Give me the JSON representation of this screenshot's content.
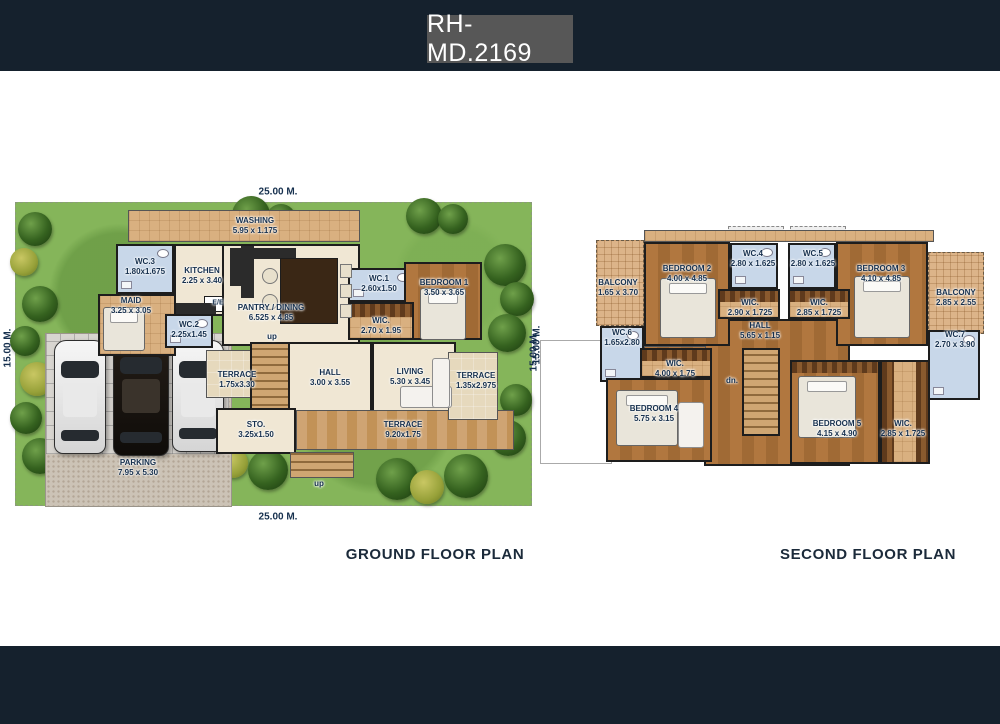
{
  "header": {
    "title": "RH-MD.2169"
  },
  "colors": {
    "header_bg": "#15212d",
    "title_box_bg": "#575757",
    "caption_color": "#1b2a3a",
    "lawn_green": "#85b55a",
    "room_label_color": "#16304e",
    "wc_blue": "#c8d7e9",
    "wood_brown": "#b1773f"
  },
  "ground_floor": {
    "caption": "GROUND FLOOR PLAN",
    "dims": {
      "top": "25.00 M.",
      "bottom": "25.00 M.",
      "left": "15.00 M.",
      "right": "15.00 M."
    },
    "rooms": {
      "washing": {
        "name": "WASHING",
        "size": "5.95 x 1.175"
      },
      "wc3": {
        "name": "WC.3",
        "size": "1.80x1.675"
      },
      "kitchen": {
        "name": "KITCHEN",
        "size": "2.25 x 3.40"
      },
      "maid": {
        "name": "MAID",
        "size": "3.25 x 3.05"
      },
      "wc2": {
        "name": "WC.2",
        "size": "2.25x1.45"
      },
      "electrical": {
        "name": "E/E"
      },
      "pantry_dining": {
        "name": "PANTRY / DINING",
        "size": "6.525 x 4.85"
      },
      "wc1": {
        "name": "WC.1",
        "size": "2.60x1.50"
      },
      "bedroom1": {
        "name": "BEDROOM 1",
        "size": "3.50 x 3.65"
      },
      "wic": {
        "name": "WIC.",
        "size": "2.70 x 1.95"
      },
      "terrace_left": {
        "name": "TERRACE",
        "size": "1.75x3.30"
      },
      "hall": {
        "name": "HALL",
        "size": "3.00 x 3.55"
      },
      "living": {
        "name": "LIVING",
        "size": "5.30 x 3.45"
      },
      "storage": {
        "name": "STO.",
        "size": "3.25x1.50"
      },
      "terrace_bottom": {
        "name": "TERRACE",
        "size": "9.20x1.75"
      },
      "terrace_right": {
        "name": "TERRACE",
        "size": "1.35x2.975"
      },
      "parking": {
        "name": "PARKING",
        "size": "7.95 x 5.30"
      }
    },
    "stair_label_up_main": "up",
    "stair_label_up_terrace": "up"
  },
  "second_floor": {
    "caption": "SECOND FLOOR PLAN",
    "dims": {
      "left": "15.00 M."
    },
    "rooms": {
      "balcony_left": {
        "name": "BALCONY",
        "size": "1.65 x 3.70"
      },
      "bedroom2": {
        "name": "BEDROOM 2",
        "size": "4.00 x 4.85"
      },
      "wc4": {
        "name": "WC.4",
        "size": "2.80 x 1.625"
      },
      "wc5": {
        "name": "WC.5",
        "size": "2.80 x 1.625"
      },
      "bedroom3": {
        "name": "BEDROOM 3",
        "size": "4.10 x 4.85"
      },
      "balcony_right": {
        "name": "BALCONY",
        "size": "2.85 x 2.55"
      },
      "wc6": {
        "name": "WC.6",
        "size": "1.65x2.80"
      },
      "wic_bedroom2": {
        "name": "WIC.",
        "size": "2.90 x 1.725"
      },
      "wic_bedroom3": {
        "name": "WIC.",
        "size": "2.85 x 1.725"
      },
      "hall": {
        "name": "HALL",
        "size": "5.65 x 1.15"
      },
      "wc7": {
        "name": "WC.7",
        "size": "2.70 x 3.90"
      },
      "wic_bedroom4": {
        "name": "WIC.",
        "size": "4.00 x 1.75"
      },
      "bedroom4": {
        "name": "BEDROOM 4",
        "size": "5.75 x 3.15"
      },
      "bedroom5": {
        "name": "BEDROOM 5",
        "size": "4.15 x 4.90"
      },
      "wic_bedroom5": {
        "name": "WIC.",
        "size": "2.85 x 1.725"
      }
    },
    "stair_label_down": "dn."
  }
}
